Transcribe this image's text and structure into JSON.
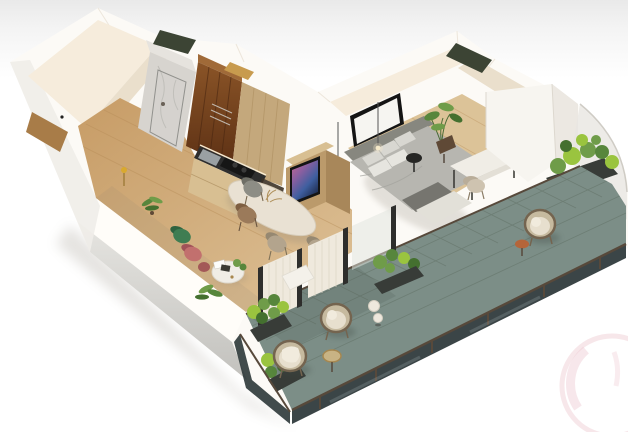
{
  "meta": {
    "description": "3D isometric cutaway render of a one-bedroom apartment with a wrap-around balcony, no visible text",
    "image_type": "architectural-3d-floorplan-render",
    "visible_text": ""
  },
  "scene": {
    "rooms": [
      {
        "name": "entry-hall",
        "features": [
          "wood-floor",
          "entry-door-handle",
          "wood-console"
        ]
      },
      {
        "name": "bathroom",
        "features": [
          "marble-walls",
          "glass-shower-door"
        ]
      },
      {
        "name": "wardrobe-niche",
        "features": [
          "dark-wood-panels",
          "towel-rail",
          "ceiling-opening"
        ]
      },
      {
        "name": "kitchen",
        "features": [
          "light-wood-cabinets",
          "dark-counter",
          "cooktop",
          "sink",
          "under-cabinet-light"
        ]
      },
      {
        "name": "living-dining",
        "features": [
          "marble-dining-table",
          "four-chairs",
          "green-armchair",
          "pink-armchair",
          "round-coffee-table",
          "magazines",
          "ferns"
        ]
      },
      {
        "name": "media-partition",
        "features": [
          "wood-slab",
          "framed-abstract-art"
        ]
      },
      {
        "name": "bedroom",
        "features": [
          "gray-upholstered-bed",
          "pillows",
          "throw-blanket",
          "blank-framed-canvas",
          "two-pendant-lights",
          "black-side-table",
          "potted-plant",
          "white-desk",
          "desk-chair",
          "mirror-niche"
        ]
      },
      {
        "name": "balcony",
        "features": [
          "teal-gray-tile-floor",
          "glass-railing",
          "three-wicker-egg-chairs",
          "planters-with-greenery",
          "curtained-sliding-doors",
          "ball-lamps",
          "gold-side-table",
          "terracotta-side-table",
          "curved-glass-corner"
        ]
      }
    ],
    "camera": "isometric-top-down-cutaway",
    "watermark": {
      "shape": "partial-pink-circle",
      "position": "bottom-right"
    }
  },
  "colors": {
    "wall_top": "#fcfaf6",
    "wall_cream": "#f6ecdc",
    "wall_cream_dark": "#eadfcc",
    "face_top": "#e6e5e1",
    "face_bottom": "#c2c1bd",
    "floor1": "#c79c66",
    "floor2": "#ddc197",
    "floor_line": "#b68c58",
    "floor_bed": "#dcc398",
    "wood_dark1": "#8a5427",
    "wood_dark2": "#5c3014",
    "cabinet": "#c4a87c",
    "cabinet_light": "#d8bf92",
    "marble": "#d7d4cf",
    "marble_vein": "#b7b4af",
    "counter": "#2e2e2e",
    "cooktop": "#161616",
    "steel": "#9aa0a3",
    "led": "#fff3da",
    "table_marble": "#e9e1d3",
    "chair_gray": "#8d8d85",
    "chair_gray_dark": "#6e6e66",
    "chair_brown": "#9b7a5a",
    "chair_brown_dark": "#7e5f42",
    "chair_taupe": "#b3a48d",
    "chair_taupe_dark": "#968871",
    "chair_green": "#3f7d52",
    "chair_green_dark": "#2f6340",
    "chair_pink": "#c2706e",
    "chair_pink_dark": "#a05258",
    "bed_head": "#87877f",
    "bed_duvet": "#b7b6b0",
    "bed_fold": "#a3a29c",
    "bed_throw": "#76756f",
    "bed_blanket": "#e2e0d8",
    "pillow": "#d8d7d1",
    "pillow_light": "#e6e5df",
    "art_frame": "#141414",
    "canvas": "#f6f5f1",
    "art1": "#c9688f",
    "art2": "#8a5fa0",
    "art3": "#3f5fa0",
    "art4": "#1d2b4d",
    "plant_deep": "#44702f",
    "plant_dark": "#57863c",
    "plant_mid": "#6f9c49",
    "plant_bright": "#9ac43f",
    "planter": "#383c38",
    "pot": "#5f4936",
    "tile": "#7c8e87",
    "tile_line": "#69796f",
    "rail": "#57493b",
    "glass_dark": "#2c3739",
    "wicker": "#c6ba9f",
    "wicker_rim": "#74644f",
    "cushion": "#e7dfce",
    "towel": "#f1ebdd",
    "curtain": "#efe9dd",
    "curtain_line": "#dcd3c2",
    "frame_dark": "#2e2e2c",
    "white_box": "#f4f1ea",
    "desk": "#f0ede6",
    "mirror_frame": "#2b2a27",
    "mirror1": "#7b7b77",
    "mirror2": "#4e4e4a",
    "skylight": "#3c4434",
    "gold": "#a8874e",
    "gold_fill": "#cdb684",
    "orange": "#b5653a",
    "lamp": "#eee8dd",
    "bulb": "#f5e9c9",
    "shadow": "#8a8274",
    "watermark": "#f2d7dc",
    "watermark2": "#eec9d2",
    "handle": "#222222"
  }
}
